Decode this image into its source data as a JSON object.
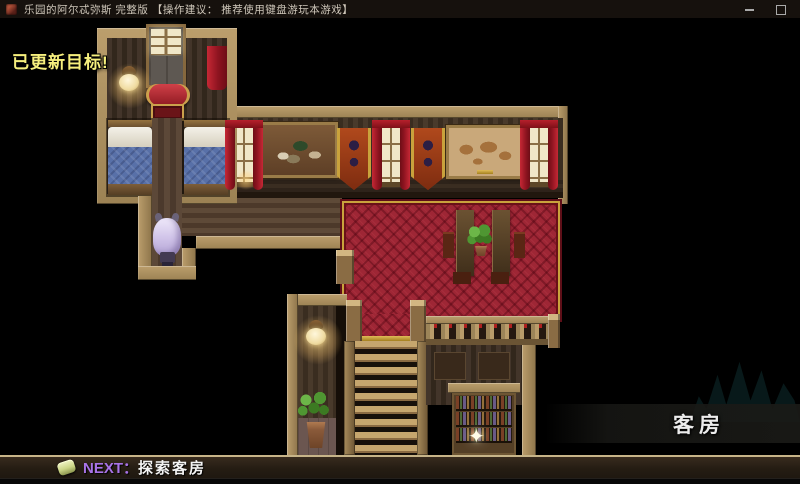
{
  "window": {
    "title": "乐园的阿尔忒弥斯 完整版 【操作建议： 推荐使用键盘游玩本游戏】"
  },
  "hud": {
    "objective_toast": "已更新目标!",
    "location_banner": "客房",
    "quest": {
      "next_label": "NEXT：",
      "task": "探索客房"
    }
  },
  "icons": {
    "sparkle_glyph": "✦"
  },
  "colors": {
    "toast_yellow": "#f6ef7d",
    "next_purple": "#a873e8",
    "carpet_red": "#9e2635",
    "gold_trim": "#c9a23c",
    "wood_tan": "#a98f60",
    "quest_bar_bg": "#251d13",
    "quest_bar_border": "#c7b488",
    "location_band_bg": "#1a1a17"
  }
}
